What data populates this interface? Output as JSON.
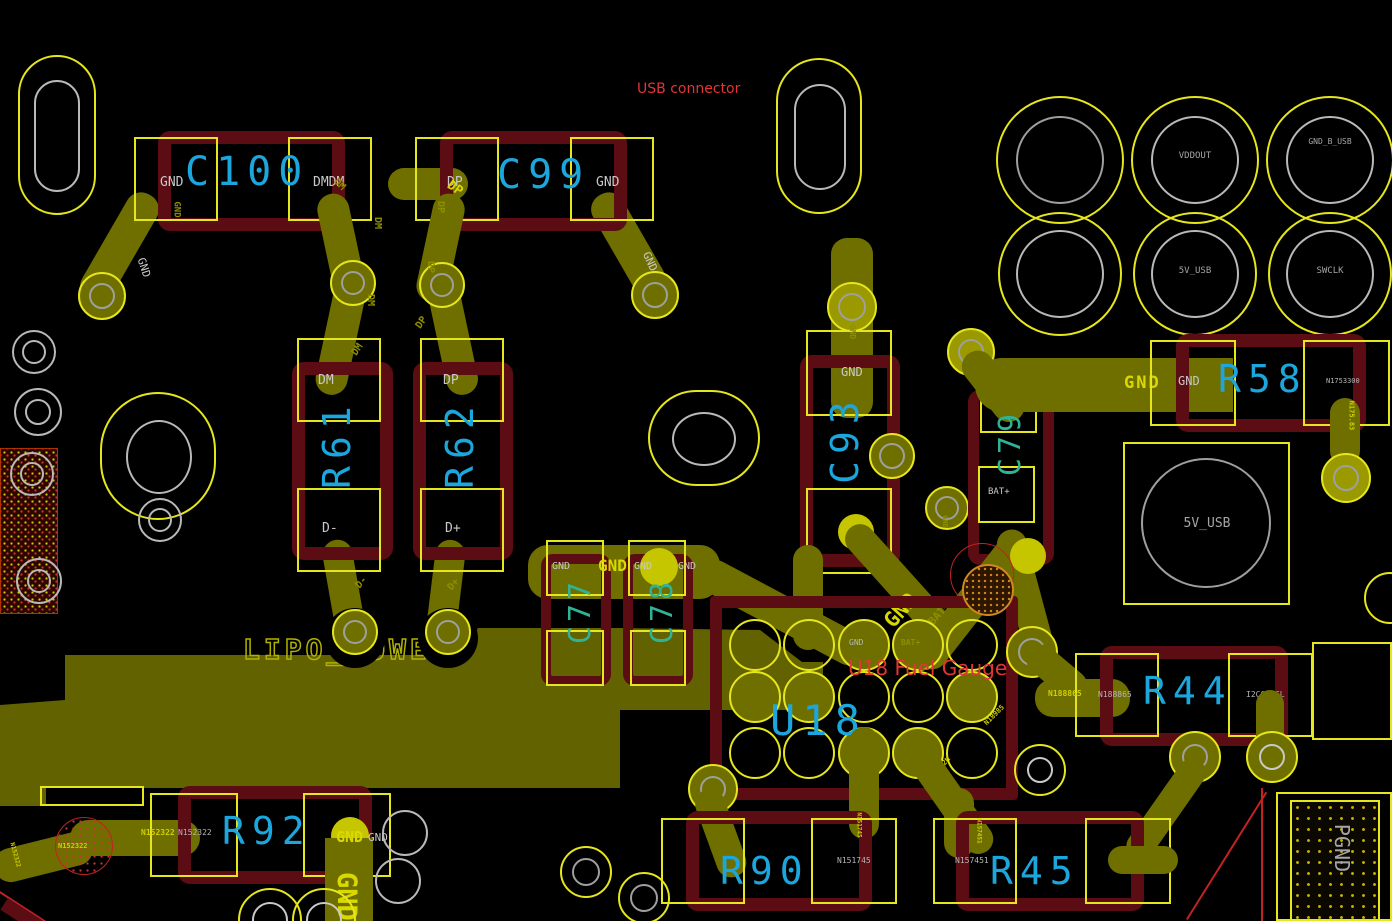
{
  "annotations": {
    "usb_connector": "USB connector",
    "fuel_gauge": "U18 Fuel Gauge"
  },
  "refs": {
    "c100": "C100",
    "c99": "C99",
    "r61": "R61",
    "r62": "R62",
    "c93": "C93",
    "c79": "C79",
    "c77": "C77",
    "c78": "C78",
    "r58": "R58",
    "u18": "U18",
    "r44": "R44",
    "r92": "R92",
    "r90": "R90",
    "r45": "R45"
  },
  "pads": {
    "c100_left": "GND",
    "c100_right": "DMDM",
    "c99_left": "DP",
    "c99_right": "GND",
    "r61_top": "DM",
    "r61_bottom": "D-",
    "r62_top": "DP",
    "r62_bottom": "D+",
    "c93_top": "GND",
    "c79_top": "GND",
    "c79_right": "GND",
    "c79_bottom": "BAT+",
    "c77_top": "GND",
    "c78_top": "GND",
    "c78_right": "GND",
    "r58_left": "GND",
    "r58_right": "N1753300",
    "u18_gnd": "GND",
    "u18_bat": "BAT+",
    "r44_left": "N188865",
    "r44_right": "I2C0_SCL",
    "r92_left": "N152322",
    "r92_right": "GND",
    "r90_right": "N151745",
    "r45_left": "N157451",
    "r45_right": "I2C0_SDA"
  },
  "testpoints": {
    "vddout": "VDDOUT",
    "usb_shield": "GND_B_USB",
    "five_v_usb": "5V_USB",
    "swclk": "SWCLK",
    "five_v_usb_pad": "5V_USB",
    "pgnd": "PGND"
  },
  "nets": {
    "gnd": "GND",
    "dm": "DM",
    "dp": "DP",
    "d_minus": "D-",
    "d_plus": "D+",
    "bat_plus": "BAT+",
    "lipo_power": "LIPO_POWER",
    "n152322": "N152322",
    "n1753300": "N1753300",
    "n175_83": "N175.83",
    "n188865": "N188865",
    "n18985": "N18985",
    "n1822m": "N1822M",
    "n151745": "N151745",
    "n157451": "N157451"
  }
}
